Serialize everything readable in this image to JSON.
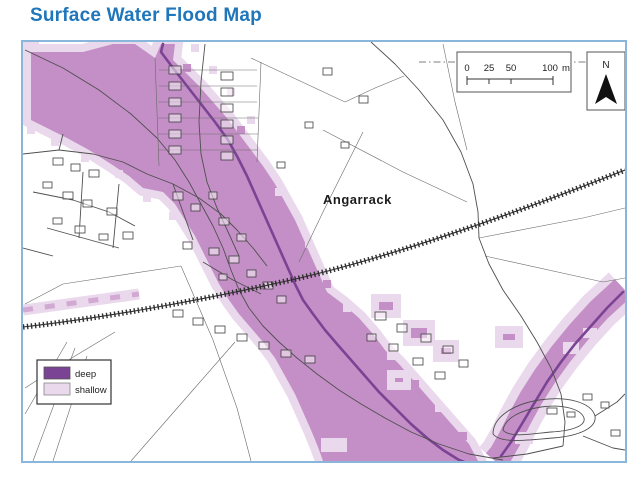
{
  "title": "Surface Water Flood Map",
  "colors": {
    "title_blue": "#1f76bb",
    "frame_blue": "#8ab6dc",
    "flood_deep": "#7a4394",
    "flood_main": "#c48fc6",
    "flood_shallow": "#ead9ec"
  },
  "map": {
    "place_label": "Angarrack",
    "north_label": "N",
    "scale_bar": {
      "ticks": [
        "0",
        "25",
        "50",
        "100"
      ],
      "unit": "m"
    },
    "legend": {
      "items": [
        {
          "label": "deep",
          "color": "#7a4394"
        },
        {
          "label": "shallow",
          "color": "#ead9ec"
        }
      ]
    }
  }
}
